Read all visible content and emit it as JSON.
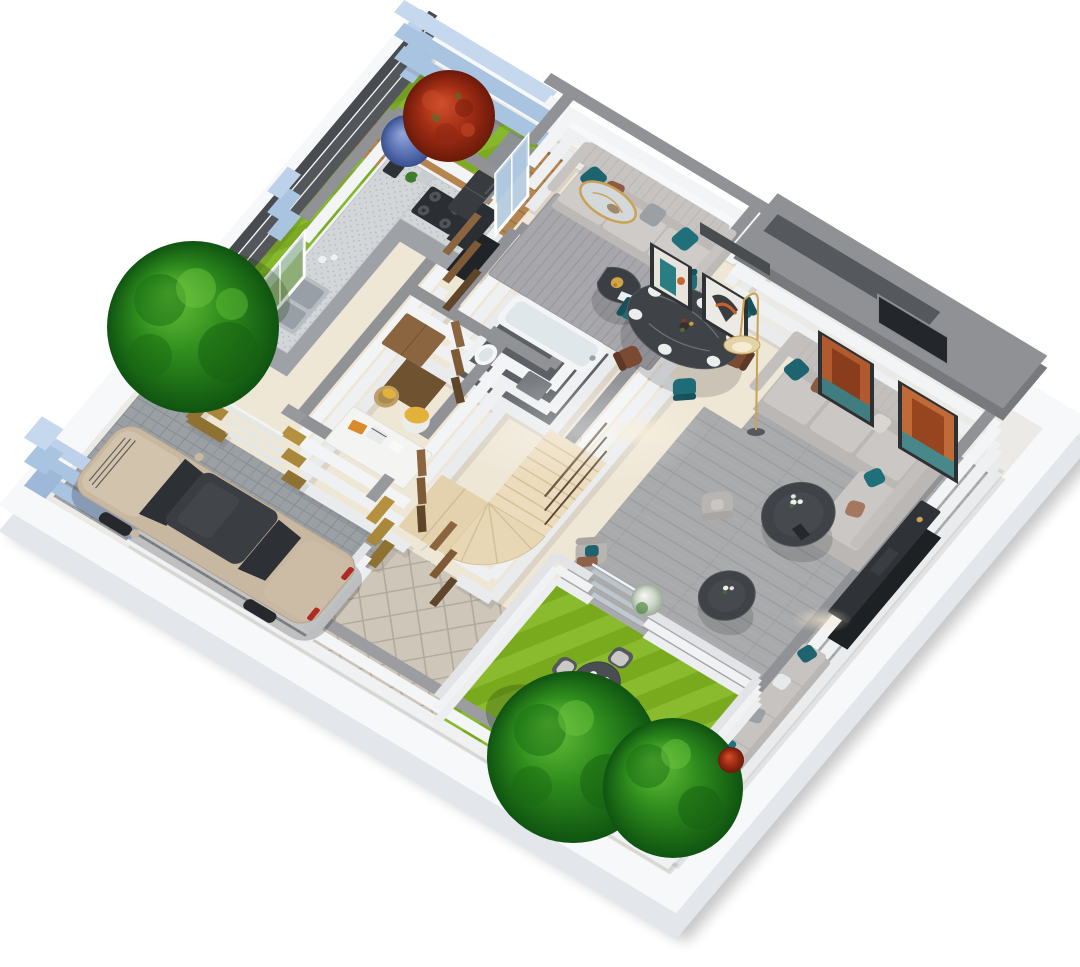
{
  "document": {
    "title": "3D isometric floor plan render — ground floor of a house with carport, kitchen, reception lounge, dining area, living room, winder staircase, bathroom, study nook and two gardens",
    "background": "#ffffff"
  },
  "palette": {
    "plinth": "#f7f8f9",
    "plinthFace": "#e3e6ea",
    "wallFace": "#e9ebed",
    "wallCap": "#909296",
    "blueWall": "#a9c4e1",
    "blueWallCap": "#c5d8ee",
    "fence": "#53575b",
    "fenceCap": "#484b4f",
    "gold": "#a9873b",
    "goldCap": "#97999c",
    "marble": "#efe7d6",
    "grayFloor": "#a9aaac",
    "rug": "#a8a7ac",
    "bathFloor": "#5d6166",
    "stairs": "#ecdcbd",
    "deck": "#b5854f",
    "paver": "#9ba0a5",
    "pathTile": "#cdc6b9",
    "grassSide": "#7cab22",
    "grassBack": "#79aa1e",
    "treeLight": "#63bb35",
    "treeDark": "#0f5411",
    "bushRed": "#a02c14",
    "bushBlue": "#5c73b4",
    "bushWhite": "#eef2ec",
    "sofaGray": "#c6c3c0",
    "sectional": "#bab7b4",
    "teal": "#1d6470",
    "brown": "#8c5b43",
    "tableDark": "#3f4347",
    "chairTeal": "#1f6b77",
    "chairBrown": "#7b4a33",
    "woodDoor": "#7e5a36",
    "carBody": "#c8b8a2",
    "carGlass": "#2d3034",
    "taillight": "#b02a25",
    "counterTop": "#d3d6d8",
    "cabinet": "#9ea2a6",
    "fridge": "#383c41",
    "tub": "#f2f4f5",
    "glassPanel": "#d8e8f4",
    "lampGold": "#c9a254",
    "glow": "#f6e3b0",
    "artOrange": "#b15a2e",
    "artTeal": "#2a7d82",
    "yellowThrow": "#e3b23c",
    "accentOrange": "#d98a2b"
  },
  "scene": {
    "view": "isometric-3d-render",
    "floor": "ground-floor",
    "rooms": [
      {
        "id": "side-garden",
        "name": "Side Garden",
        "features": [
          "lawn",
          "red-flowering-shrub",
          "blue-flowering-shrub",
          "stepping-stones",
          "timber-deck-walkway",
          "boundary-tree"
        ]
      },
      {
        "id": "reception",
        "name": "Reception Lounge",
        "features": [
          "three-seat-sofa",
          "accent-pillows",
          "area-rug",
          "organic-coffee-table",
          "fruit-bowl",
          "oval-gold-mirror",
          "window-to-deck"
        ]
      },
      {
        "id": "dining",
        "name": "Dining Area",
        "features": [
          "oval-marble-dining-table",
          "six-dining-chairs",
          "place-settings",
          "two-wall-artworks",
          "arc-floor-lamp",
          "wall-niche"
        ]
      },
      {
        "id": "living",
        "name": "Living Room",
        "features": [
          "l-shaped-sectional-sofa",
          "accent-pillows",
          "two-round-coffee-tables",
          "flower-vases",
          "two-accent-armchairs",
          "media-console",
          "window-seat-bench",
          "two-wall-artworks",
          "dark-wall-opening"
        ]
      },
      {
        "id": "kitchen",
        "name": "Kitchen",
        "features": [
          "l-shaped-counter",
          "double-sink",
          "four-burner-cooktop",
          "refrigerator",
          "coffee-machine",
          "window-over-sink",
          "glass-slider-to-carport",
          "gold-accent-walls"
        ]
      },
      {
        "id": "bathroom",
        "name": "Bathroom",
        "features": [
          "bathtub",
          "toilet",
          "dark-tile-floor",
          "timber-door"
        ]
      },
      {
        "id": "staircase",
        "name": "Winder Staircase",
        "features": [
          "straight-flight",
          "fan-winder-treads",
          "landing",
          "handrail"
        ]
      },
      {
        "id": "study",
        "name": "Study Nook",
        "features": [
          "white-desk",
          "laptop",
          "orange-folder",
          "chair-with-yellow-throw",
          "storage-basket",
          "timber-cabinet",
          "timber-door"
        ]
      },
      {
        "id": "backyard",
        "name": "Backyard Garden",
        "features": [
          "lawn",
          "round-outdoor-table",
          "four-outdoor-chairs",
          "two-trees",
          "white-flowering-shrub",
          "red-flowering-shrub",
          "glass-balustrade",
          "low-white-walls"
        ]
      },
      {
        "id": "carport",
        "name": "Carport / Driveway",
        "features": [
          "paver-floor",
          "parked-sedan",
          "blue-entry-gate",
          "slat-fence"
        ]
      },
      {
        "id": "entry-path",
        "name": "Entry Walkway",
        "features": [
          "diamond-paving",
          "open-timber-entry-door",
          "gold-accent-piers"
        ]
      }
    ],
    "vehicle": {
      "type": "sedan",
      "color_name": "champagne",
      "facing": "gate"
    },
    "counts": {
      "trees": 3,
      "flowering_shrubs": 4,
      "timber_doors": 4,
      "windows": 2,
      "wall_artworks": 4,
      "mirrors": 1,
      "sofas": 3,
      "tables": 6,
      "chairs": 13
    }
  }
}
